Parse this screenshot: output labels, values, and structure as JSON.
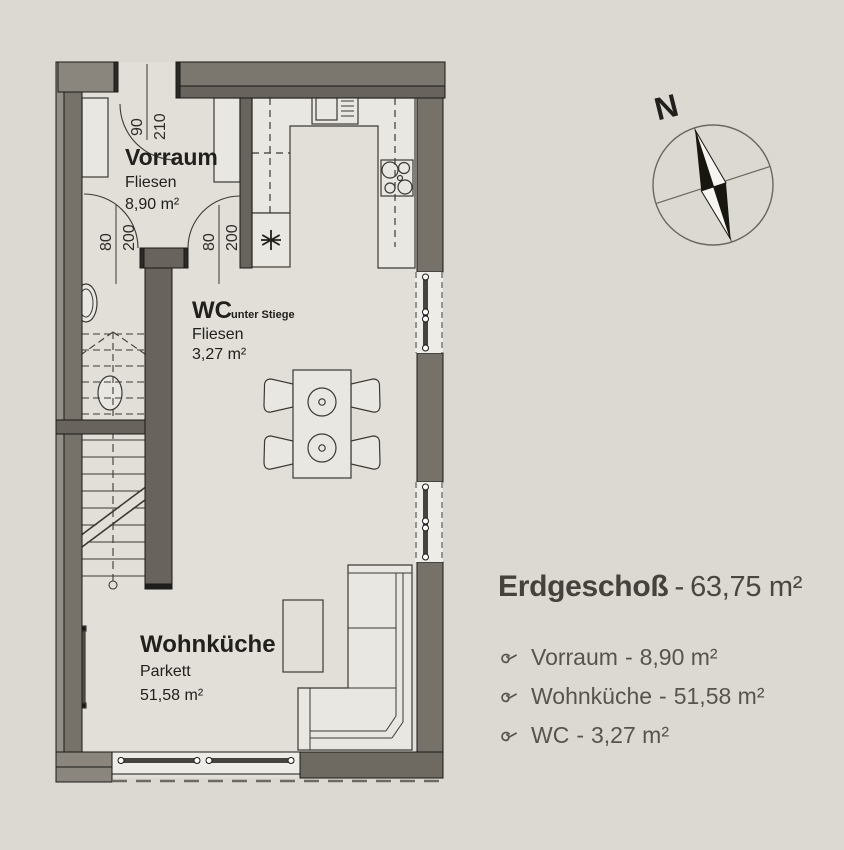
{
  "colors": {
    "background": "#dcd8d2",
    "wall_dark": "#6e6a62",
    "wall_light": "#8a867e",
    "line": "#3c3a36",
    "text": "#21201d",
    "legend_text": "#57544e"
  },
  "plan": {
    "rooms": {
      "vorraum": {
        "name": "Vorraum",
        "floor": "Fliesen",
        "area": "8,90 m²"
      },
      "wc": {
        "name": "WC",
        "suffix": "unter Stiege",
        "floor": "Fliesen",
        "area": "3,27 m²"
      },
      "wohnkueche": {
        "name": "Wohnküche",
        "floor": "Parkett",
        "area": "51,58 m²"
      }
    },
    "doors": {
      "entry": {
        "width": "90",
        "height": "210"
      },
      "vorraum_left": {
        "width": "80",
        "height": "200"
      },
      "vorraum_right": {
        "width": "80",
        "height": "200"
      }
    },
    "compass": {
      "label": "N"
    }
  },
  "legend": {
    "title": "Erdgeschoß",
    "separator": "-",
    "total_area": "63,75 m²",
    "items": [
      {
        "label": "Vorraum",
        "separator": "-",
        "area": "8,90 m²"
      },
      {
        "label": "Wohnküche",
        "separator": "-",
        "area": "51,58 m²"
      },
      {
        "label": "WC",
        "separator": "-",
        "area": "3,27 m²"
      }
    ]
  }
}
